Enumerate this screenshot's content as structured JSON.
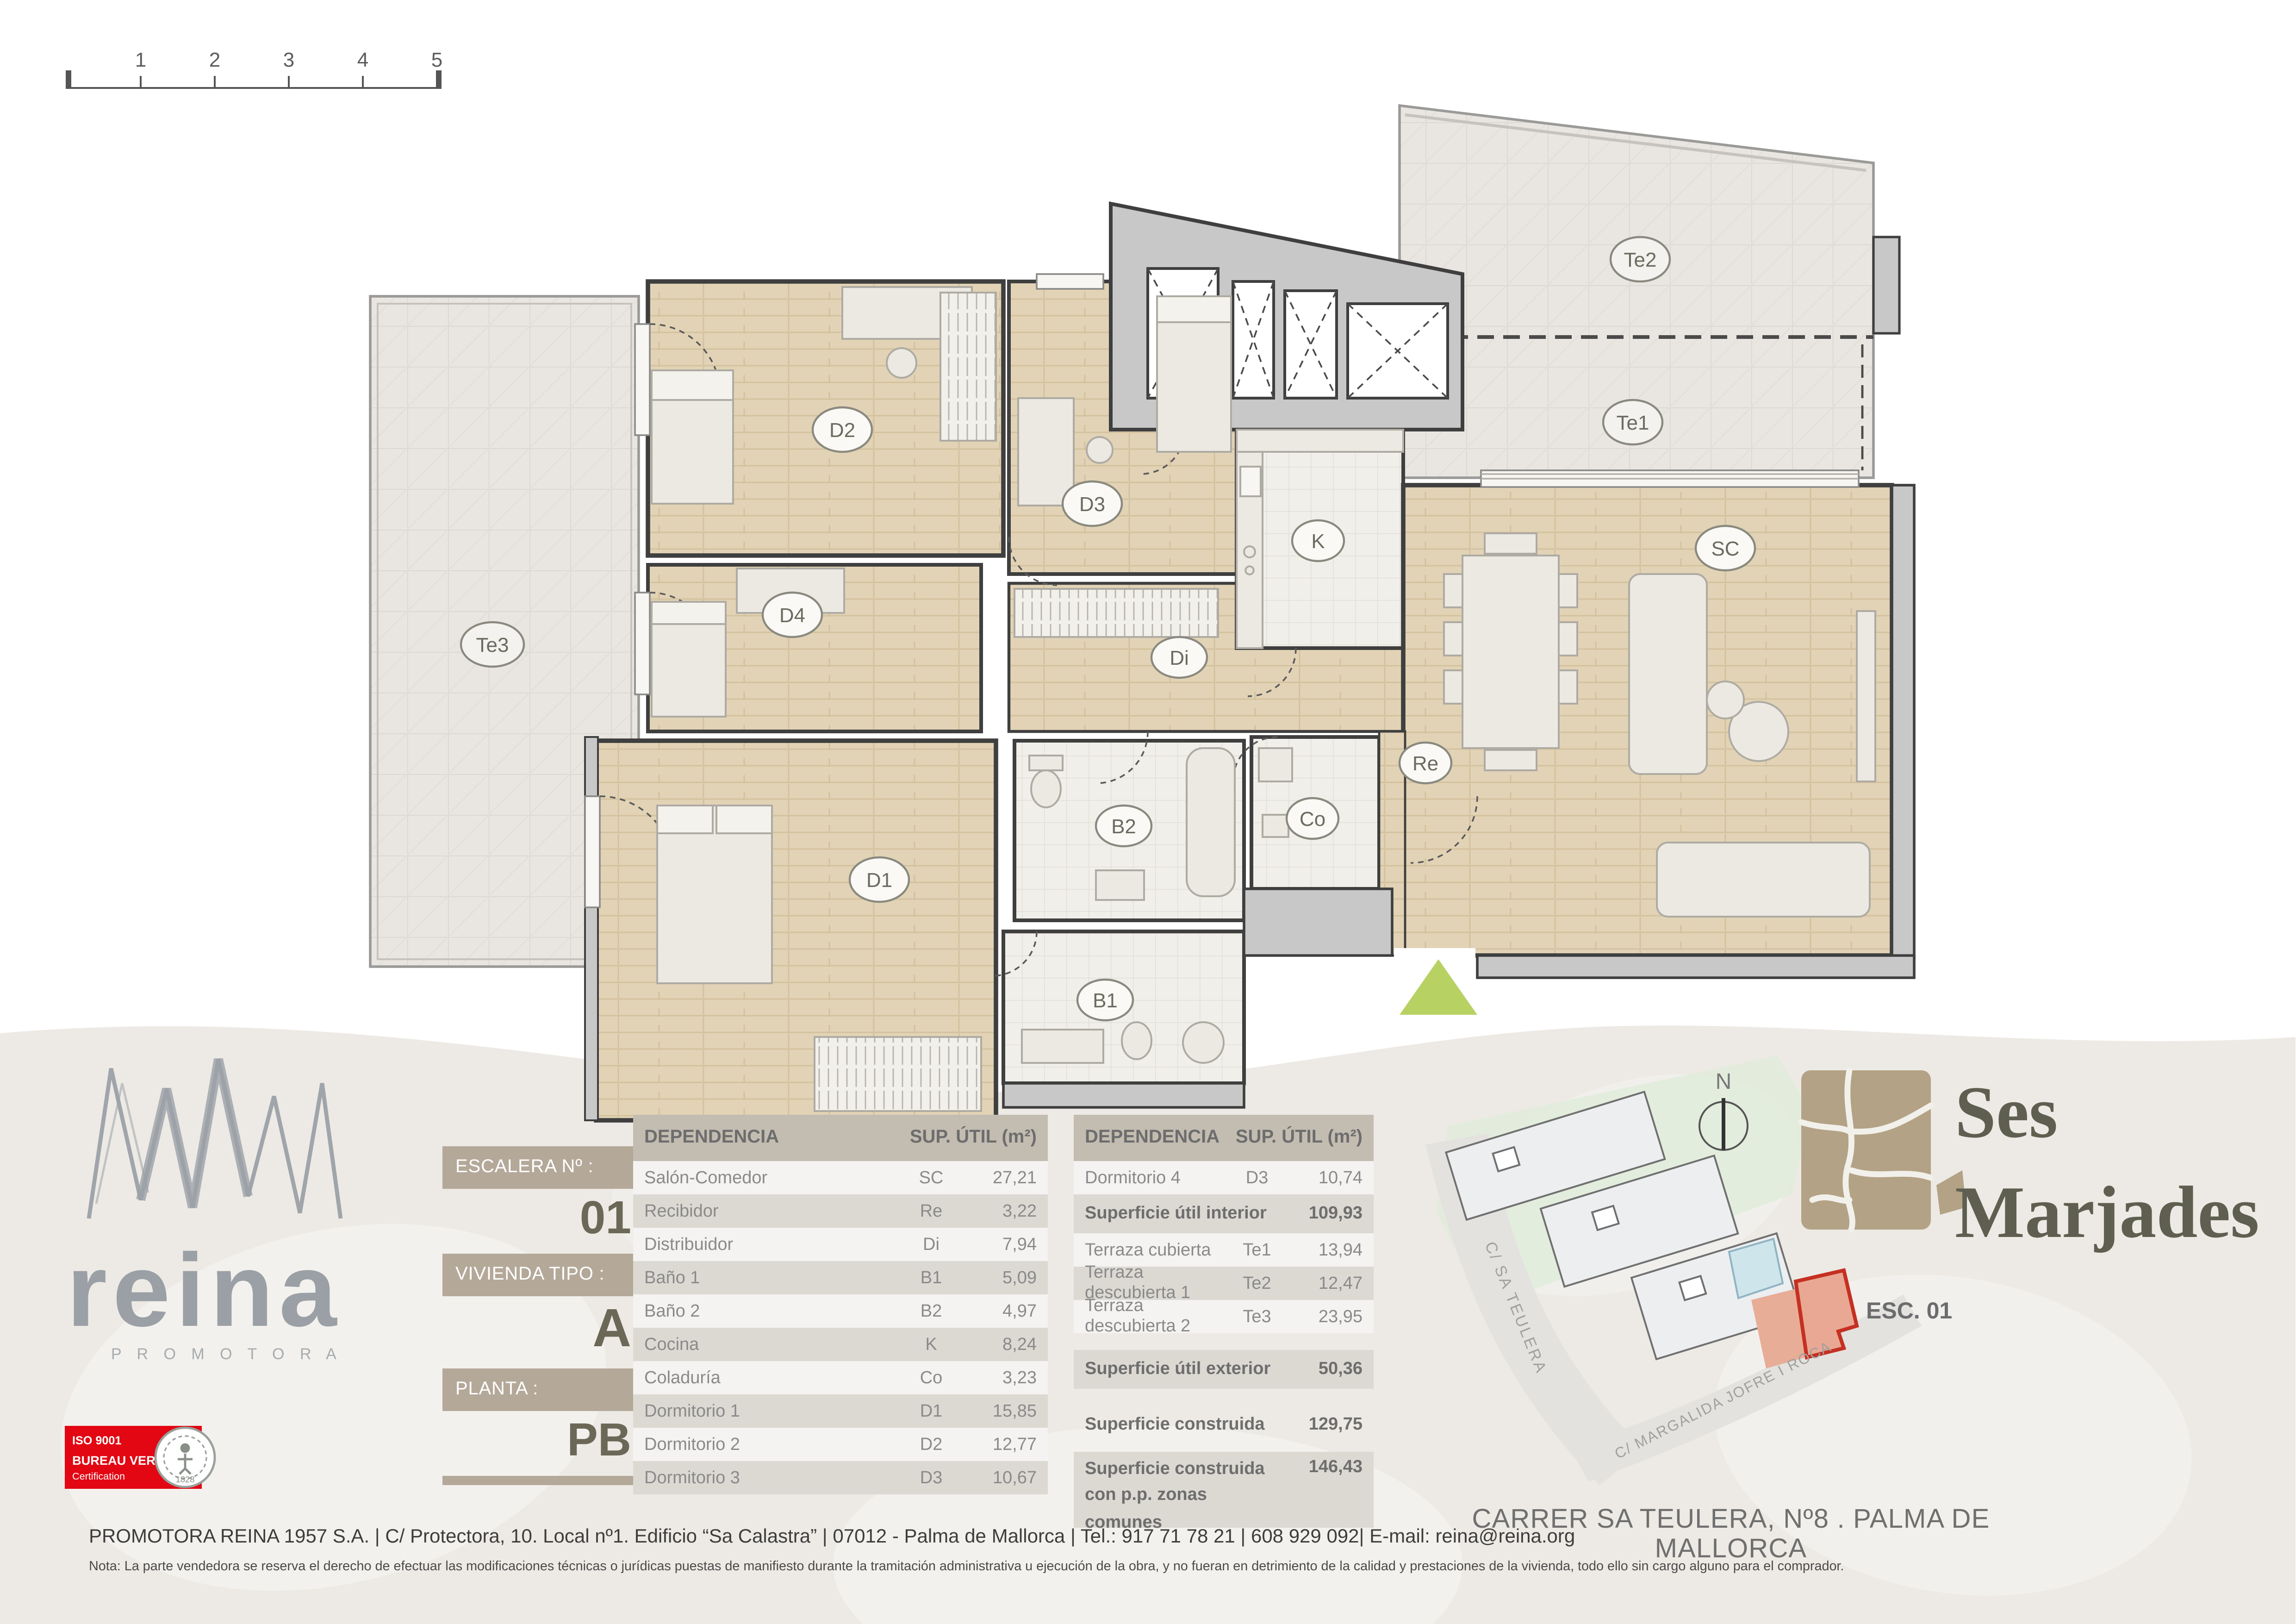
{
  "sheet": {
    "address_line": "CARRER SA TEULERA, Nº8 . PALMA DE MALLORCA",
    "footer_company_line": "PROMOTORA REINA 1957 S.A. | C/ Protectora, 10. Local nº1. Edificio “Sa Calastra” | 07012 - Palma de Mallorca | Tel.: 917 71 78 21 | 608 929 092| E-mail: reina@reina.org",
    "footer_note": "Nota: La parte vendedora se reserva el derecho de efectuar las modificaciones técnicas o jurídicas puestas de manifiesto durante la tramitación administrativa u ejecución de la obra, y no fueran en detrimiento de la calidad y prestaciones de la vivienda, todo ello sin cargo alguno para el comprador."
  },
  "ruler": {
    "marks": [
      "1",
      "2",
      "3",
      "4",
      "5"
    ]
  },
  "plan": {
    "rooms": {
      "sc": "SC",
      "re": "Re",
      "di": "Di",
      "b1": "B1",
      "b2": "B2",
      "k": "K",
      "co": "Co",
      "d1": "D1",
      "d2": "D2",
      "d3": "D3",
      "d4": "D4",
      "te1": "Te1",
      "te2": "Te2",
      "te3": "Te3"
    }
  },
  "panel": {
    "escalera_label": "ESCALERA Nº :",
    "escalera_value": "01",
    "vivienda_label": "VIVIENDA TIPO :",
    "vivienda_value": "A",
    "planta_label": "PLANTA :",
    "planta_value": "PB"
  },
  "tables": {
    "left": {
      "col_dependencia": "DEPENDENCIA",
      "col_sup": "SUP. ÚTIL (m²)",
      "rows": [
        {
          "name": "Salón-Comedor",
          "code": "SC",
          "value": "27,21"
        },
        {
          "name": "Recibidor",
          "code": "Re",
          "value": "3,22"
        },
        {
          "name": "Distribuidor",
          "code": "Di",
          "value": "7,94"
        },
        {
          "name": "Baño 1",
          "code": "B1",
          "value": "5,09"
        },
        {
          "name": "Baño 2",
          "code": "B2",
          "value": "4,97"
        },
        {
          "name": "Cocina",
          "code": "K",
          "value": "8,24"
        },
        {
          "name": "Coladuría",
          "code": "Co",
          "value": "3,23"
        },
        {
          "name": "Dormitorio 1",
          "code": "D1",
          "value": "15,85"
        },
        {
          "name": "Dormitorio 2",
          "code": "D2",
          "value": "12,77"
        },
        {
          "name": "Dormitorio 3",
          "code": "D3",
          "value": "10,67"
        }
      ]
    },
    "right": {
      "col_dependencia": "DEPENDENCIA",
      "col_sup": "SUP. ÚTIL (m²)",
      "rows": [
        {
          "name": "Dormitorio 4",
          "code": "D3",
          "value": "10,74"
        },
        {
          "name": "Superficie útil interior",
          "code": "",
          "value": "109,93"
        },
        {
          "name": "Terraza cubierta",
          "code": "Te1",
          "value": "13,94"
        },
        {
          "name": "Terraza descubierta 1",
          "code": "Te2",
          "value": "12,47"
        },
        {
          "name": "Terraza descubierta 2",
          "code": "Te3",
          "value": "23,95"
        },
        {
          "name": "Superficie útil exterior",
          "code": "",
          "value": "50,36"
        },
        {
          "name": "Superficie construida",
          "code": "",
          "value": "129,75"
        },
        {
          "name": "Superficie construida",
          "name2": "con p.p. zonas comunes",
          "code": "",
          "value": "146,43"
        }
      ]
    }
  },
  "brand": {
    "reina": "reina",
    "promotora": "P R O M O T O R A"
  },
  "iso": {
    "line1": "ISO 9001",
    "line2": "BUREAU VERITAS",
    "line3": "Certification",
    "seal_year": "1828"
  },
  "project": {
    "name_line1": "Ses",
    "name_line2": "Marjades",
    "esc": "ESC. 01",
    "north": "N"
  },
  "site": {
    "street1": "C/ SA TEULERA",
    "street2": "C/ MARGALIDA JOFRE I ROCA"
  },
  "colors": {
    "accent_tan": "#b4a899",
    "brand_gray": "#9aa0a5",
    "badge_red": "#e30613",
    "entrance_green": "#b8d163",
    "unit_red": "#c53022",
    "logo_tan": "#b3a285",
    "logo_olive": "#5e5f50",
    "wall_gray": "#c8c8c8",
    "wood": "#e2d3b6"
  }
}
